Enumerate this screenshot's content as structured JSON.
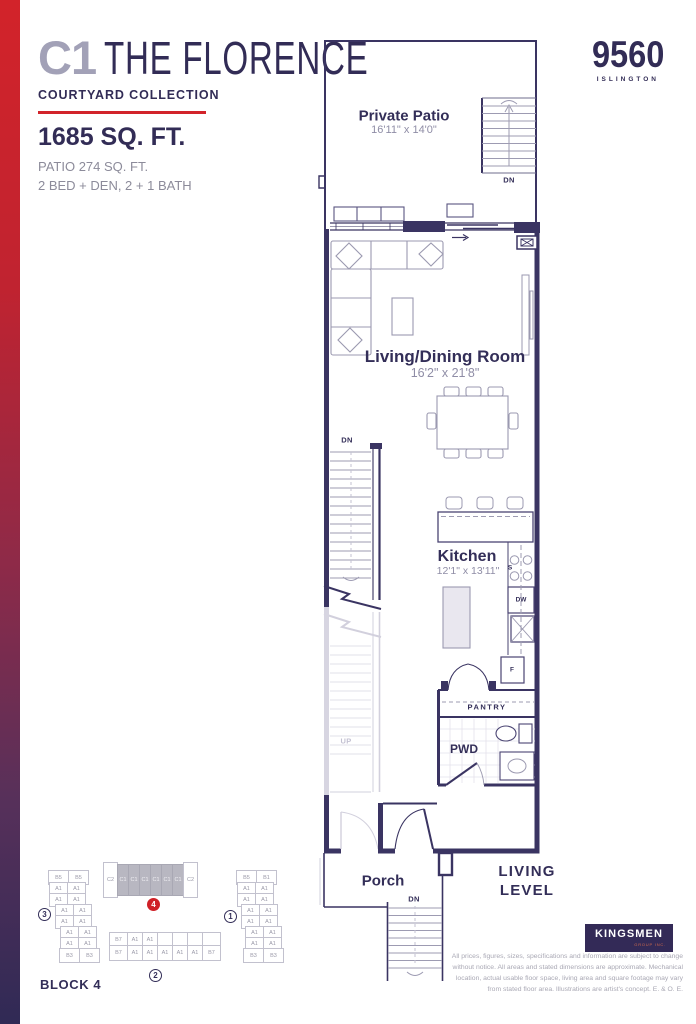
{
  "header": {
    "unit_code": "C1",
    "unit_name": "THE FLORENCE",
    "collection": "COURTYARD COLLECTION",
    "area": "1685 SQ. FT.",
    "patio_area": "PATIO 274 SQ. FT.",
    "bed_bath": "2 BED + DEN, 2 + 1 BATH"
  },
  "brand": {
    "number": "9560",
    "name": "ISLINGTON"
  },
  "floorplan": {
    "private_patio": {
      "label": "Private Patio",
      "dims": "16'11\" x 14'0\""
    },
    "living_dining": {
      "label": "Living/Dining Room",
      "dims": "16'2\" x 21'8\""
    },
    "kitchen": {
      "label": "Kitchen",
      "dims": "12'1\" x 13'11\""
    },
    "pantry": "PANTRY",
    "powder_room": "PWD",
    "porch": "Porch",
    "stair_down": "DN",
    "stair_up": "UP",
    "sink": "S",
    "dishwasher": "DW",
    "fridge": "F"
  },
  "level": {
    "line1": "LIVING",
    "line2": "LEVEL"
  },
  "keyplan": {
    "block3": {
      "number": "3",
      "rows": [
        [
          "B5",
          "B5"
        ],
        [
          "A1",
          "A1"
        ],
        [
          "A1",
          "A1"
        ],
        [
          "A1",
          "A1"
        ],
        [
          "A1",
          "A1"
        ],
        [
          "A1",
          "A1"
        ],
        [
          "A1",
          "A1"
        ],
        [
          "B3",
          "B3"
        ]
      ]
    },
    "block4": {
      "number": "4",
      "cells": [
        "C2",
        "C1",
        "C1",
        "C1",
        "C1",
        "C1",
        "C1",
        "C2"
      ]
    },
    "block2": {
      "number": "2",
      "top_row": [
        "B7",
        "A1",
        "A1",
        "",
        "",
        "",
        ""
      ],
      "bottom_row": [
        "B7",
        "A1",
        "A1",
        "A1",
        "A1",
        "A1",
        "B7"
      ]
    },
    "block1": {
      "number": "1",
      "rows": [
        [
          "B5",
          "B1"
        ],
        [
          "A1",
          "A1"
        ],
        [
          "A1",
          "A1"
        ],
        [
          "A1",
          "A1"
        ],
        [
          "A1",
          "A1"
        ],
        [
          "A1",
          "A1"
        ],
        [
          "A1",
          "A1"
        ],
        [
          "B3",
          "B3"
        ]
      ]
    },
    "caption": "BLOCK 4"
  },
  "footer": {
    "logo_text": "KINGSMEN",
    "logo_sub": "GROUP INC.",
    "disclaimer_lines": [
      "All prices, figures, sizes, specifications and information are subject to change",
      "without notice. All areas and stated dimensions are approximate. Mechanical",
      "location, actual usable floor space, living area and square footage may vary",
      "from stated floor area. Illustrations are artist's concept. E. & O. E."
    ]
  },
  "colors": {
    "accent_red": "#d2232a",
    "navy": "#332e58",
    "gradient_top": "#d2232a",
    "gradient_bottom": "#302a55",
    "keyplan_highlight": "#b8b7c1"
  }
}
